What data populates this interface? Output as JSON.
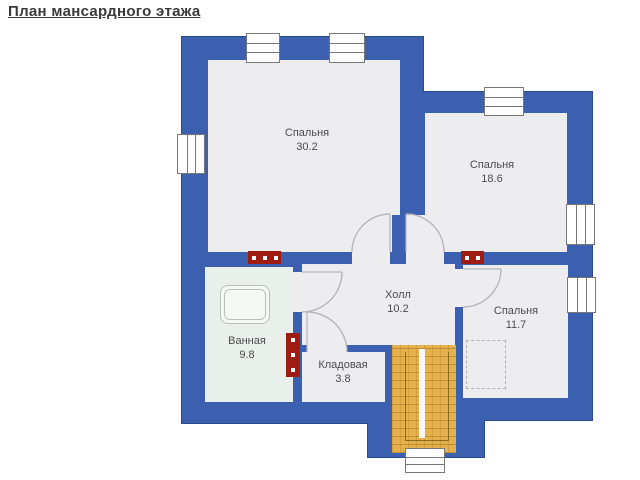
{
  "title": {
    "text": "План мансардного этажа"
  },
  "colors": {
    "wall": "#3c60b0",
    "wall_outline": "#2b4a8e",
    "floor": "#ededf0",
    "bath_floor": "#e9efea",
    "stairs": "#e6b14c",
    "stairs_grid": "rgba(146,106,22,0.45)",
    "stairs_inner": "#8a6a1e",
    "stairs_strip": "#f7f7f2",
    "flue": "#9e1c12",
    "window_frame": "#777777",
    "door": "#b5b5ba",
    "furniture": "#b9c0b9",
    "label": "#4c4c50"
  },
  "floorplan": {
    "walls": [
      {
        "x": 182,
        "y": 37,
        "w": 241,
        "h": 386
      },
      {
        "x": 423,
        "y": 92,
        "w": 169,
        "h": 328
      },
      {
        "x": 368,
        "y": 398,
        "w": 116,
        "h": 59
      }
    ],
    "floors": [
      {
        "name": "bedroom-30",
        "x": 208,
        "y": 60,
        "w": 192,
        "h": 192,
        "c": "floor"
      },
      {
        "name": "bedroom-18",
        "x": 425,
        "y": 113,
        "w": 142,
        "h": 139,
        "c": "floor"
      },
      {
        "name": "bedroom-18-ext",
        "x": 406,
        "y": 215,
        "w": 19,
        "h": 37,
        "c": "floor"
      },
      {
        "name": "hall",
        "x": 302,
        "y": 264,
        "w": 153,
        "h": 81,
        "c": "floor"
      },
      {
        "name": "bathroom",
        "x": 205,
        "y": 267,
        "w": 88,
        "h": 135,
        "c": "bath_floor"
      },
      {
        "name": "storage",
        "x": 302,
        "y": 352,
        "w": 83,
        "h": 50,
        "c": "floor"
      },
      {
        "name": "bedroom-11",
        "x": 463,
        "y": 265,
        "w": 105,
        "h": 133,
        "c": "floor"
      }
    ],
    "overlay_walls": [
      {
        "x": 392,
        "y": 215,
        "w": 14,
        "h": 37
      }
    ],
    "openings": [
      {
        "x": 352,
        "y": 252,
        "w": 38,
        "h": 12,
        "c": "floor"
      },
      {
        "x": 406,
        "y": 252,
        "w": 38,
        "h": 12,
        "c": "floor"
      },
      {
        "x": 293,
        "y": 272,
        "w": 9,
        "h": 40,
        "c": "floor"
      },
      {
        "x": 307,
        "y": 345,
        "w": 40,
        "h": 7,
        "c": "floor"
      },
      {
        "x": 455,
        "y": 269,
        "w": 8,
        "h": 38,
        "c": "floor"
      }
    ],
    "windows": [
      {
        "x": 246,
        "y": 33,
        "w": 32,
        "h": 28,
        "o": "h"
      },
      {
        "x": 329,
        "y": 33,
        "w": 34,
        "h": 28,
        "o": "h"
      },
      {
        "x": 484,
        "y": 87,
        "w": 38,
        "h": 27,
        "o": "h"
      },
      {
        "x": 177,
        "y": 134,
        "w": 26,
        "h": 38,
        "o": "v"
      },
      {
        "x": 566,
        "y": 204,
        "w": 27,
        "h": 39,
        "o": "v"
      },
      {
        "x": 567,
        "y": 277,
        "w": 27,
        "h": 34,
        "o": "v"
      },
      {
        "x": 405,
        "y": 448,
        "w": 38,
        "h": 23,
        "o": "h"
      }
    ],
    "flues": [
      {
        "x": 248,
        "y": 251,
        "w": 33,
        "h": 13,
        "dots": 3,
        "o": "h"
      },
      {
        "x": 286,
        "y": 333,
        "w": 14,
        "h": 44,
        "dots": 3,
        "o": "v"
      },
      {
        "x": 461,
        "y": 251,
        "w": 23,
        "h": 13,
        "dots": 2,
        "o": "h"
      }
    ],
    "stairs": {
      "x": 392,
      "y": 345,
      "w": 64,
      "h": 108,
      "strip": {
        "x": 27,
        "y": 4,
        "w": 6,
        "h": 89
      },
      "inner": {
        "x": 13,
        "y": 7,
        "w": 42,
        "h": 88
      }
    },
    "furniture": [
      {
        "type": "bathtub",
        "x": 220,
        "y": 285,
        "w": 48,
        "h": 37
      },
      {
        "type": "wardrobe",
        "x": 466,
        "y": 340,
        "w": 38,
        "h": 47
      }
    ],
    "doors": [
      {
        "arc": "M 390 214 A 38 38 0 0 0 352 252",
        "leaf": "M 390 252 L 390 214"
      },
      {
        "arc": "M 406 214 A 38 38 0 0 1 444 252",
        "leaf": "M 406 252 L 406 214"
      },
      {
        "arc": "M 342 272 A 40 40 0 0 1 302 312",
        "leaf": "M 302 272 L 342 272"
      },
      {
        "arc": "M 307 312 A 40 40 0 0 1 347 352",
        "leaf": "M 307 352 L 307 312"
      },
      {
        "arc": "M 501 269 A 38 38 0 0 1 463 307",
        "leaf": "M 463 269 L 501 269"
      }
    ],
    "rooms": [
      {
        "name": "Спальня",
        "area": "30.2",
        "cx": 307,
        "cy": 140
      },
      {
        "name": "Спальня",
        "area": "18.6",
        "cx": 492,
        "cy": 172
      },
      {
        "name": "Холл",
        "area": "10.2",
        "cx": 398,
        "cy": 302
      },
      {
        "name": "Ванная",
        "area": "9.8",
        "cx": 247,
        "cy": 348
      },
      {
        "name": "Кладовая",
        "area": "3.8",
        "cx": 343,
        "cy": 372
      },
      {
        "name": "Спальня",
        "area": "11.7",
        "cx": 516,
        "cy": 318
      }
    ]
  }
}
